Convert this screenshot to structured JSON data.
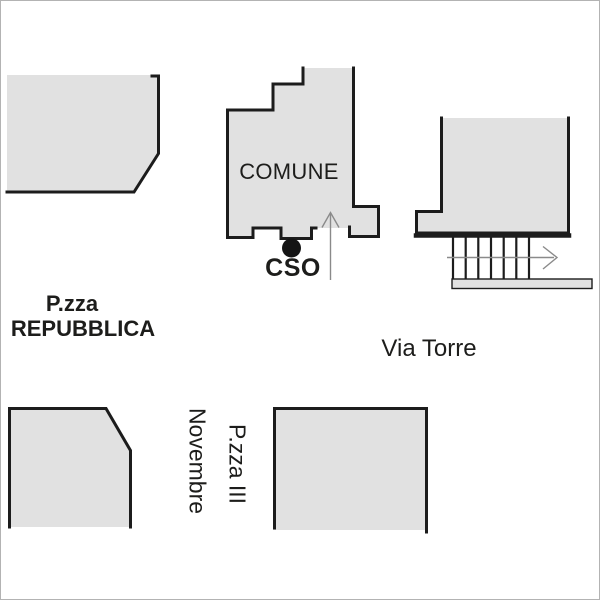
{
  "map": {
    "type": "street-map",
    "colors": {
      "background": "#ffffff",
      "frame": "#b3b3b3",
      "building_fill": "#e1e1e1",
      "building_stroke": "#1c1c1c",
      "arrow": "#8a8a8a",
      "text": "#1d1d1b"
    },
    "buildings": {
      "comune": {
        "label": "COMUNE"
      }
    },
    "places": {
      "cso": {
        "label": "CSO",
        "marker": "black-dot"
      },
      "piazza_repubblica": {
        "line1": "P.zza",
        "line2": "REPUBBLICA"
      },
      "via_torre": {
        "label": "Via Torre"
      },
      "piazza_iii_novembre": {
        "line1": "P.zza III",
        "line2": "Novembre"
      }
    },
    "icons": {
      "entrance_arrow": "up-arrow",
      "street_direction_arrow": "right-arrow",
      "stairs": "hatched-steps"
    }
  }
}
